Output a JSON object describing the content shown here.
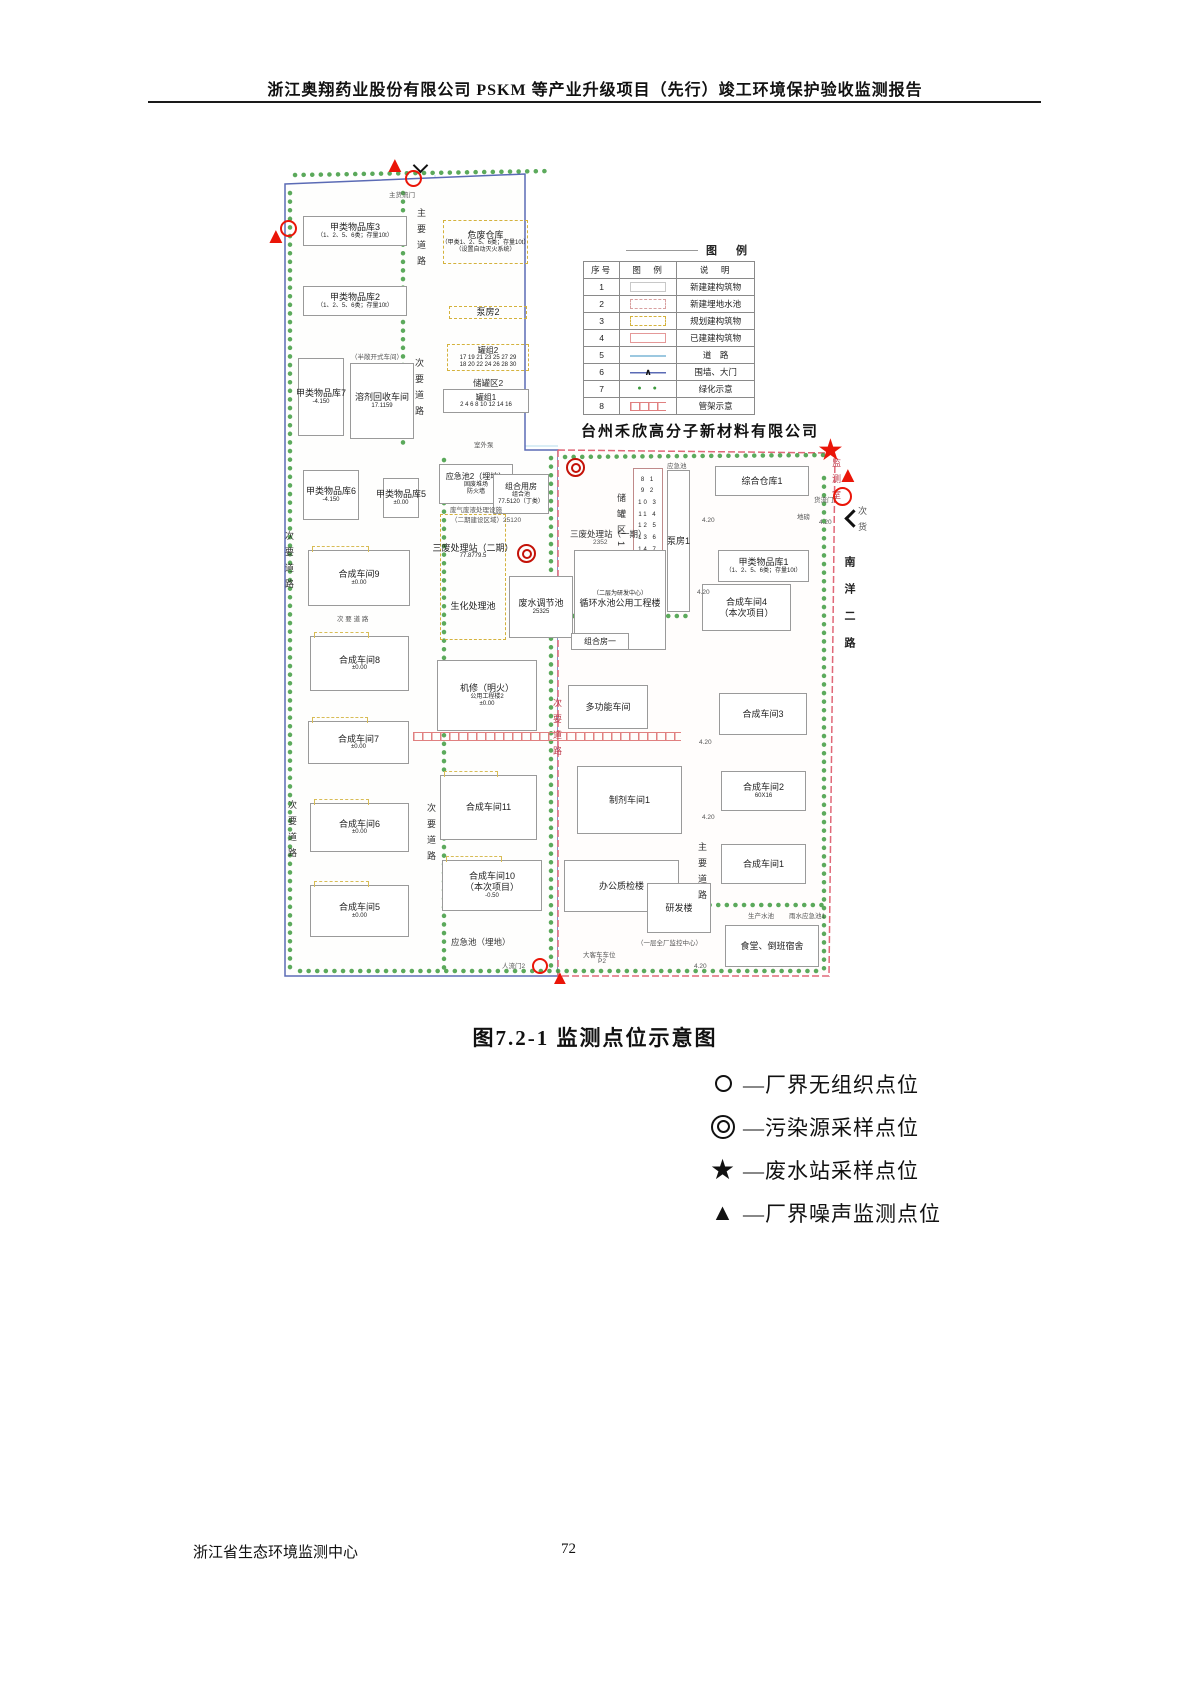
{
  "header": {
    "title": "浙江奥翔药业股份有限公司 PSKM 等产业升级项目（先行）竣工环境保护验收监测报告"
  },
  "caption": "图7.2-1  监测点位示意图",
  "footer": {
    "org": "浙江省生态环境监测中心",
    "page": "72"
  },
  "colors": {
    "marker_red": "#ea1508",
    "boundary_blue": "#5b6bb5",
    "boundary_red": "#e06878",
    "planned_yellow": "#d4b23c",
    "tree_green": "#3f9b3f",
    "road_blue": "#9cc8e0"
  },
  "legend": {
    "title": "图 例",
    "headers": [
      "序号",
      "图　例",
      "说　明"
    ],
    "rows": [
      {
        "no": "1",
        "sw": "new",
        "desc": "新建建构筑物"
      },
      {
        "no": "2",
        "sw": "pool",
        "desc": "新建埋地水池"
      },
      {
        "no": "3",
        "sw": "plan",
        "desc": "规划建构筑物"
      },
      {
        "no": "4",
        "sw": "built",
        "desc": "已建建构筑物"
      },
      {
        "no": "5",
        "sw": "road",
        "desc": "道　路"
      },
      {
        "no": "6",
        "sw": "wall",
        "chr": "∧",
        "desc": "围墙、大门"
      },
      {
        "no": "7",
        "sw": "green",
        "chr": "●　●",
        "desc": "绿化示意"
      },
      {
        "no": "8",
        "sw": "pipe",
        "desc": "管架示意"
      }
    ]
  },
  "point_legend": {
    "items": [
      {
        "sym": "circle",
        "label": "—厂界无组织点位"
      },
      {
        "sym": "dcircle",
        "label": "—污染源采样点位"
      },
      {
        "sym": "star",
        "sym_char": "★",
        "label": "—废水站采样点位"
      },
      {
        "sym": "triangle",
        "sym_char": "▲",
        "label": "—厂界噪声监测点位"
      }
    ]
  },
  "map": {
    "neighbor_company": "台州禾欣高分子新材料有限公司",
    "buildings": [
      {
        "n": "jialei-wupinku-3",
        "x": 50,
        "y": 68,
        "w": 104,
        "h": 30,
        "lines": [
          "甲类物品库3",
          "（1、2、5、6类；存量10t）"
        ]
      },
      {
        "n": "weifei-cangku",
        "x": 190,
        "y": 72,
        "w": 85,
        "h": 44,
        "cls": "dy",
        "lines": [
          "危废仓库",
          "（甲类1、2、5、6类；存量10t）",
          "（设置自动灭火系统）"
        ]
      },
      {
        "n": "jialei-wupinku-2",
        "x": 50,
        "y": 138,
        "w": 104,
        "h": 30,
        "lines": [
          "甲类物品库2",
          "（1、2、5、6类；存量10t）"
        ]
      },
      {
        "n": "bengfang-2",
        "x": 196,
        "y": 158,
        "w": 78,
        "h": 13,
        "cls": "dy",
        "lines": [
          "泵房2"
        ]
      },
      {
        "n": "guanzu-2",
        "x": 194,
        "y": 196,
        "w": 82,
        "h": 27,
        "cls": "dy sm",
        "lines": [
          "罐组2",
          "17 19 21 23 25 27 29",
          "18 20 22 24 26 28 30"
        ]
      },
      {
        "n": "guanzu-1",
        "x": 190,
        "y": 241,
        "w": 86,
        "h": 24,
        "cls": "sm",
        "lines": [
          "罐组1",
          "2 4 6 8 10 12 14 16"
        ]
      },
      {
        "n": "jialei-wupinku-7",
        "x": 45,
        "y": 210,
        "w": 46,
        "h": 78,
        "lines": [
          "甲类物品库7",
          "-4.150"
        ]
      },
      {
        "n": "rongji-huishou-chejian",
        "x": 97,
        "y": 215,
        "w": 64,
        "h": 76,
        "lines": [
          "溶剂回收车间",
          "17.1159"
        ]
      },
      {
        "n": "jialei-wupinku-6",
        "x": 50,
        "y": 322,
        "w": 56,
        "h": 50,
        "lines": [
          "甲类物品库6",
          "-4.150"
        ]
      },
      {
        "n": "jialei-wupinku-5",
        "x": 130,
        "y": 330,
        "w": 36,
        "h": 40,
        "lines": [
          "甲类物品库5",
          "±0.00"
        ]
      },
      {
        "n": "yingjichi-2",
        "x": 186,
        "y": 316,
        "w": 74,
        "h": 40,
        "cls": "sm",
        "lines": [
          "应急池2（埋地）",
          "固废堆场",
          "防火墙"
        ]
      },
      {
        "n": "zuhe-yongfang",
        "x": 240,
        "y": 326,
        "w": 56,
        "h": 40,
        "cls": "sm",
        "lines": [
          "组合用房",
          "组合池",
          "77.5120（丁类）"
        ]
      },
      {
        "n": "sanfei-chulizhan-erqi",
        "x": 187,
        "y": 366,
        "w": 66,
        "h": 126,
        "cls": "dy gap",
        "lines": [
          "三废处理站（二期）",
          "77.8779.5",
          "生化处理池"
        ]
      },
      {
        "n": "feishui-tiaojiechi",
        "x": 256,
        "y": 428,
        "w": 64,
        "h": 62,
        "lines": [
          "废水调节池",
          "25325"
        ]
      },
      {
        "n": "hecheng-chejian-9",
        "x": 55,
        "y": 402,
        "w": 102,
        "h": 56,
        "cls": "acc",
        "lines": [
          "合成车间9",
          "±0.00"
        ]
      },
      {
        "n": "hecheng-chejian-8",
        "x": 57,
        "y": 488,
        "w": 99,
        "h": 55,
        "cls": "acc",
        "lines": [
          "合成车间8",
          "±0.00"
        ]
      },
      {
        "n": "hecheng-chejian-7",
        "x": 55,
        "y": 573,
        "w": 101,
        "h": 43,
        "cls": "acc",
        "lines": [
          "合成车间7",
          "±0.00"
        ]
      },
      {
        "n": "hecheng-chejian-6",
        "x": 57,
        "y": 655,
        "w": 99,
        "h": 49,
        "cls": "acc",
        "lines": [
          "合成车间6",
          "±0.00"
        ]
      },
      {
        "n": "hecheng-chejian-5",
        "x": 57,
        "y": 737,
        "w": 99,
        "h": 52,
        "cls": "acc",
        "lines": [
          "合成车间5",
          "±0.00"
        ]
      },
      {
        "n": "jixiu-gongyong-gongchenglou-2",
        "x": 184,
        "y": 512,
        "w": 100,
        "h": 71,
        "lines": [
          "机修（明火）",
          "公用工程楼2",
          "±0.00"
        ]
      },
      {
        "n": "hecheng-chejian-11",
        "x": 187,
        "y": 627,
        "w": 97,
        "h": 65,
        "cls": "acc",
        "lines": [
          "合成车间11"
        ]
      },
      {
        "n": "hecheng-chejian-10",
        "x": 189,
        "y": 712,
        "w": 100,
        "h": 51,
        "cls": "acc big2",
        "lines": [
          "合成车间10",
          "（本次项目）",
          "-0.50"
        ]
      },
      {
        "n": "bengfang-1",
        "x": 414,
        "y": 322,
        "w": 23,
        "h": 142,
        "lines": [
          "泵房1"
        ]
      },
      {
        "n": "zonghe-cangku-1",
        "x": 462,
        "y": 318,
        "w": 94,
        "h": 30,
        "lines": [
          "综合仓库1"
        ]
      },
      {
        "n": "jialei-wupinku-1",
        "x": 465,
        "y": 402,
        "w": 91,
        "h": 32,
        "lines": [
          "甲类物品库1",
          "（1、2、5、6类；存量10t）"
        ]
      },
      {
        "n": "hecheng-chejian-4",
        "x": 449,
        "y": 436,
        "w": 89,
        "h": 47,
        "cls": "big2",
        "lines": [
          "合成车间4",
          "（本次项目）"
        ]
      },
      {
        "n": "hecheng-chejian-3",
        "x": 466,
        "y": 545,
        "w": 88,
        "h": 42,
        "lines": [
          "合成车间3"
        ]
      },
      {
        "n": "hecheng-chejian-2",
        "x": 468,
        "y": 623,
        "w": 85,
        "h": 40,
        "lines": [
          "合成车间2",
          "60X16"
        ]
      },
      {
        "n": "hecheng-chejian-1",
        "x": 468,
        "y": 696,
        "w": 85,
        "h": 40,
        "lines": [
          "合成车间1"
        ]
      },
      {
        "n": "zhiji-chejian-1",
        "x": 324,
        "y": 618,
        "w": 105,
        "h": 68,
        "lines": [
          "制剂车间1"
        ]
      },
      {
        "n": "duogongneng-chejian",
        "x": 315,
        "y": 537,
        "w": 80,
        "h": 44,
        "lines": [
          "多功能车间"
        ]
      },
      {
        "n": "chuguanqu-1-tanks",
        "x": 380,
        "y": 320,
        "w": 30,
        "h": 95,
        "cls": "tank",
        "lines": [
          "8 1",
          "9 2",
          "10 3",
          "11 4",
          "12 5",
          "13 6",
          "14 7"
        ]
      },
      {
        "n": "xunhuan-shuichi-gongyong-gongchenglou",
        "x": 321,
        "y": 402,
        "w": 92,
        "h": 100,
        "cls": "flip",
        "lines": [
          "（二层为研发中心）",
          "循环水池公用工程楼"
        ]
      },
      {
        "n": "zuhefang-yi",
        "x": 318,
        "y": 485,
        "w": 58,
        "h": 17,
        "cls": "sm",
        "lines": [
          "组合房一"
        ]
      },
      {
        "n": "bangong-zhijian-lou",
        "x": 311,
        "y": 712,
        "w": 115,
        "h": 52,
        "lines": [
          "办公质检楼"
        ]
      },
      {
        "n": "yanfa-lou",
        "x": 394,
        "y": 735,
        "w": 64,
        "h": 50,
        "lines": [
          "研发楼"
        ]
      },
      {
        "n": "shitang-daoban-sushe",
        "x": 472,
        "y": 777,
        "w": 94,
        "h": 42,
        "lines": [
          "食堂、倒班宿舍"
        ]
      }
    ],
    "texts": [
      {
        "t": "主货流门",
        "x": 136,
        "y": 41,
        "cls": "tiny"
      },
      {
        "t": "主要道路",
        "x": 162,
        "y": 60,
        "cls": "vert"
      },
      {
        "t": "次要道路",
        "x": 160,
        "y": 210,
        "cls": "vert"
      },
      {
        "t": "储罐区2",
        "x": 220,
        "y": 229
      },
      {
        "t": "室外泵",
        "x": 221,
        "y": 291,
        "cls": "tiny"
      },
      {
        "t": "（半敞开式车间）",
        "x": 98,
        "y": 203,
        "cls": "tiny"
      },
      {
        "t": "次要道路",
        "x": 30,
        "y": 383,
        "cls": "vert"
      },
      {
        "t": "次要道路",
        "x": 33,
        "y": 652,
        "cls": "vert"
      },
      {
        "t": "次 要 道 路",
        "x": 84,
        "y": 465,
        "cls": "tiny"
      },
      {
        "t": "次要道路",
        "x": 172,
        "y": 655,
        "cls": "vert"
      },
      {
        "t": "应急池（埋地）",
        "x": 198,
        "y": 788
      },
      {
        "t": "人流门2",
        "x": 249,
        "y": 812,
        "cls": "tiny"
      },
      {
        "t": "大客车车位",
        "x": 330,
        "y": 801,
        "cls": "tiny"
      },
      {
        "t": "P2",
        "x": 345,
        "y": 810,
        "cls": "tiny"
      },
      {
        "t": "废气废液处理设施",
        "x": 197,
        "y": 356,
        "cls": "tiny"
      },
      {
        "t": "（二期建设区域）25120",
        "x": 198,
        "y": 366,
        "cls": "tiny"
      },
      {
        "t": "三废处理站（一期）",
        "x": 317,
        "y": 380
      },
      {
        "t": "2352",
        "x": 340,
        "y": 391,
        "cls": "tiny"
      },
      {
        "t": "储罐区1",
        "x": 362,
        "y": 345,
        "cls": "vert"
      },
      {
        "t": "应急池",
        "x": 414,
        "y": 312,
        "cls": "tiny"
      },
      {
        "t": "次要道路",
        "x": 298,
        "y": 550,
        "cls": "vert red"
      },
      {
        "t": "主要道路",
        "x": 443,
        "y": 694,
        "cls": "vert"
      },
      {
        "t": "南洋二路",
        "x": 588,
        "y": 408,
        "cls": "vert road2"
      },
      {
        "t": "监测室",
        "x": 577,
        "y": 310,
        "cls": "vert tiny red"
      },
      {
        "t": "货流门1",
        "x": 561,
        "y": 346,
        "cls": "tiny"
      },
      {
        "t": "次货",
        "x": 603,
        "y": 358,
        "cls": "vert tiny"
      },
      {
        "t": "地磅",
        "x": 544,
        "y": 363,
        "cls": "tiny"
      },
      {
        "t": "生产水池",
        "x": 495,
        "y": 762,
        "cls": "tiny"
      },
      {
        "t": "雨水应急池1",
        "x": 536,
        "y": 762,
        "cls": "tiny"
      },
      {
        "t": "（一层全厂监控中心）",
        "x": 384,
        "y": 789,
        "cls": "tiny"
      },
      {
        "t": "4.20",
        "x": 449,
        "y": 369,
        "cls": "tiny"
      },
      {
        "t": "4.20",
        "x": 444,
        "y": 441,
        "cls": "tiny"
      },
      {
        "t": "4.20",
        "x": 446,
        "y": 591,
        "cls": "tiny"
      },
      {
        "t": "4.20",
        "x": 449,
        "y": 666,
        "cls": "tiny"
      },
      {
        "t": "4.20",
        "x": 441,
        "y": 815,
        "cls": "tiny"
      },
      {
        "t": "4.20",
        "x": 566,
        "y": 371,
        "cls": "tiny"
      }
    ],
    "markers": [
      {
        "type": "triangle",
        "x": 131,
        "y": 6,
        "s": 22
      },
      {
        "type": "varrow",
        "x": 162,
        "y": 12
      },
      {
        "type": "circle",
        "x": 152,
        "y": 22,
        "s": 17
      },
      {
        "type": "circle",
        "x": 27,
        "y": 72,
        "s": 17
      },
      {
        "type": "triangle",
        "x": 12,
        "y": 77,
        "s": 22
      },
      {
        "type": "dcircle",
        "x": 313,
        "y": 310,
        "s": 19
      },
      {
        "type": "dcircle",
        "x": 264,
        "y": 396,
        "s": 19
      },
      {
        "type": "star",
        "x": 564,
        "y": 288,
        "s": 30
      },
      {
        "type": "triangle",
        "x": 584,
        "y": 316,
        "s": 22
      },
      {
        "type": "circle",
        "x": 580,
        "y": 339,
        "s": 19
      },
      {
        "type": "larrow",
        "x": 594,
        "y": 364
      },
      {
        "type": "circle",
        "x": 279,
        "y": 810,
        "s": 16
      },
      {
        "type": "triangle",
        "x": 297,
        "y": 820,
        "s": 20
      }
    ]
  }
}
